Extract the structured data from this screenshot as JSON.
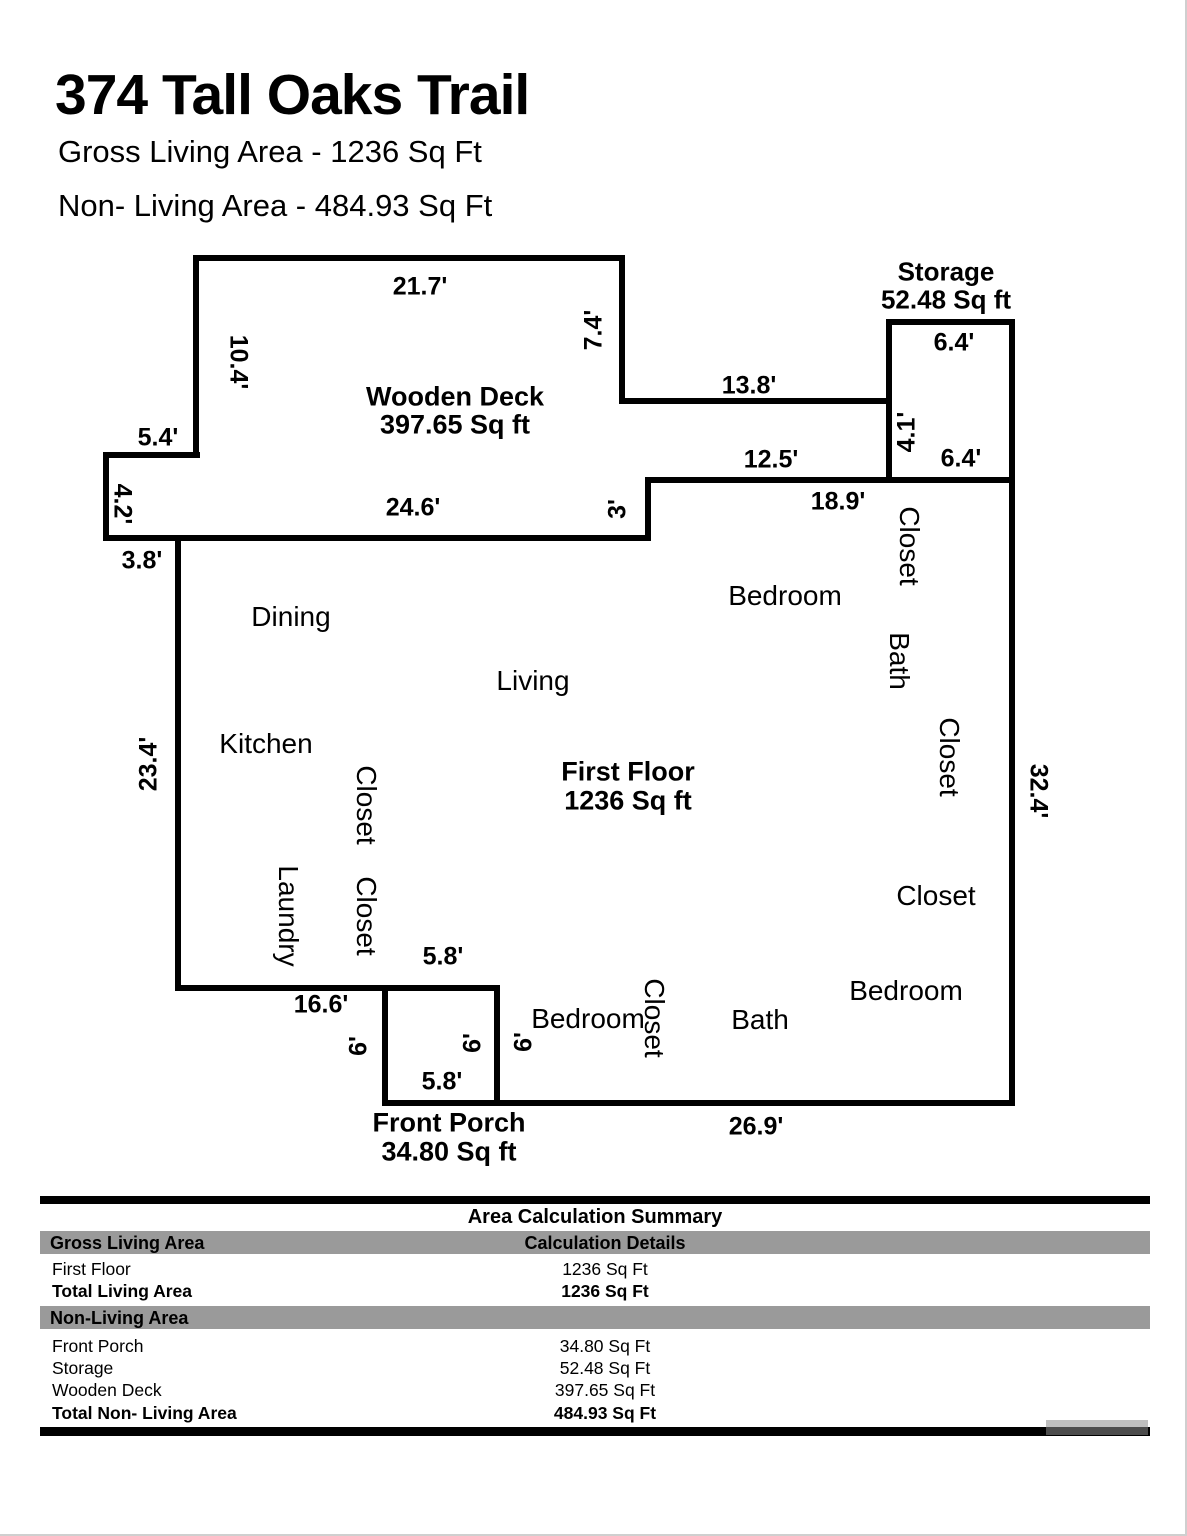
{
  "header": {
    "title": "374 Tall Oaks Trail",
    "gross_line": "Gross Living Area - 1236 Sq Ft",
    "nonliving_line": "Non- Living Area - 484.93 Sq Ft"
  },
  "floorplan": {
    "areas": {
      "wooden_deck": {
        "name": "Wooden Deck",
        "area": "397.65 Sq ft"
      },
      "storage": {
        "name": "Storage",
        "area": "52.48 Sq ft"
      },
      "first_floor": {
        "name": "First Floor",
        "area": "1236 Sq ft"
      },
      "front_porch": {
        "name": "Front Porch",
        "area": "34.80 Sq ft"
      }
    },
    "rooms": [
      "Dining",
      "Living",
      "Kitchen",
      "Bedroom",
      "Closet",
      "Bath",
      "Closet",
      "Closet",
      "Bedroom",
      "Bath",
      "Closet",
      "Bedroom",
      "Closet",
      "Closet",
      "Laundry"
    ],
    "dimensions": [
      "21.7'",
      "7.4'",
      "10.4'",
      "13.8'",
      "5.4'",
      "4.2'",
      "24.6'",
      "3'",
      "3.8'",
      "12.5'",
      "18.9'",
      "6.4'",
      "4.1'",
      "6.4'",
      "32.4'",
      "23.4'",
      "16.6'",
      "5.8'",
      "6'",
      "6'",
      "6'",
      "5.8'",
      "26.9'"
    ]
  },
  "summary": {
    "title": "Area Calculation Summary",
    "living_header": "Gross Living Area",
    "details_header": "Calculation Details",
    "living_rows": [
      {
        "label": "First Floor",
        "value": "1236 Sq Ft"
      },
      {
        "label": "Total Living Area",
        "value": "1236 Sq Ft"
      }
    ],
    "nonliving_header": "Non-Living Area",
    "nonliving_rows": [
      {
        "label": "Front Porch",
        "value": "34.80 Sq Ft"
      },
      {
        "label": "Storage",
        "value": "52.48 Sq Ft"
      },
      {
        "label": "Wooden Deck",
        "value": "397.65 Sq Ft"
      },
      {
        "label": "Total Non- Living Area",
        "value": "484.93 Sq Ft"
      }
    ]
  },
  "colors": {
    "wall": "#000000",
    "section_bar": "#9a9a9a"
  }
}
